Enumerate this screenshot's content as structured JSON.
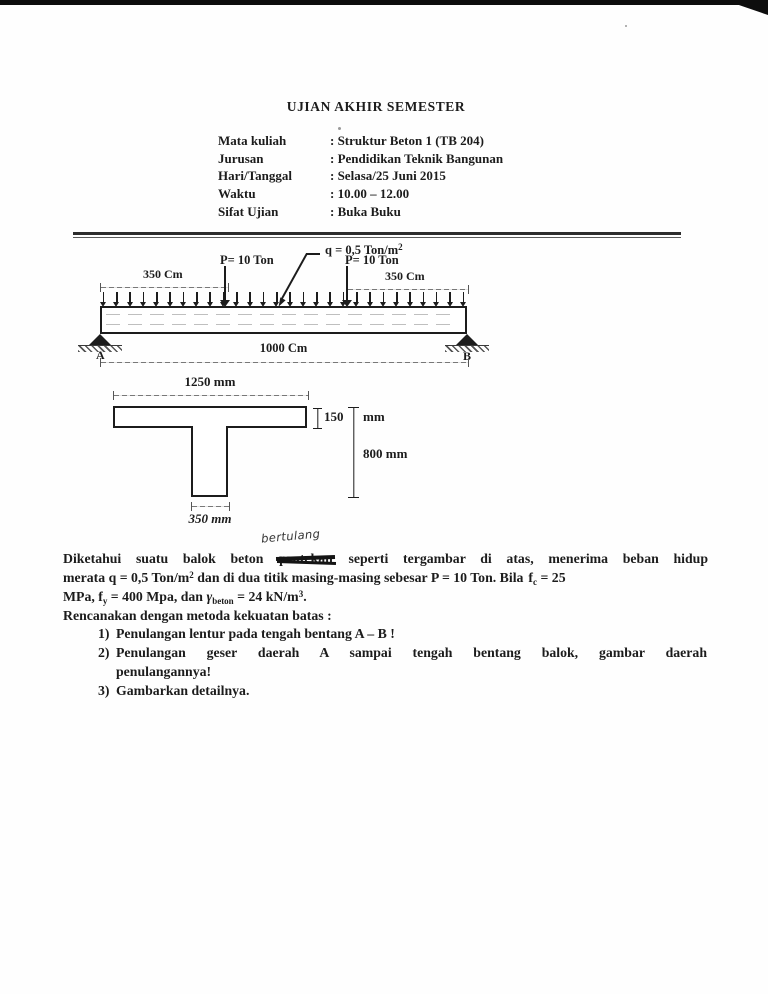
{
  "colors": {
    "ink": "#1c1c1c",
    "paper": "#fefefe",
    "dim_line": "#787878"
  },
  "header": {
    "title": "UJIAN AKHIR SEMESTER",
    "rows": [
      {
        "label": "Mata kuliah",
        "value": ": Struktur Beton 1 (TB 204)"
      },
      {
        "label": "Jurusan",
        "value": ": Pendidikan Teknik Bangunan"
      },
      {
        "label": "Hari/Tanggal",
        "value": ": Selasa/25 Juni 2015"
      },
      {
        "label": "Waktu",
        "value": ": 10.00 – 12.00"
      },
      {
        "label": "Sifat Ujian",
        "value": ": Buka Buku"
      }
    ]
  },
  "beam": {
    "q_label": "q = 0,5 Ton/m",
    "q_sup": "2",
    "p_left": "P= 10 Ton",
    "p_right": "P= 10 Ton",
    "span_left": "350 Cm",
    "span_right": "350 Cm",
    "span_total": "1000 Cm",
    "support_a": "A",
    "support_b": "B"
  },
  "section": {
    "top_width": "1250 mm",
    "flange_thickness": "150",
    "flange_unit": "mm",
    "total_depth": "800 mm",
    "web_width": "350 mm"
  },
  "problem": {
    "handwritten_note": "bertulang",
    "line1_pre": "Diketahui suatu balok beton ",
    "line1_struck": "pratekan",
    "line1_post": " seperti tergambar di atas, menerima beban hidup",
    "line2_a": "merata q = 0,5 Ton/m",
    "line2_sup": "2",
    "line2_b": " dan di dua titik masing-masing sebesar P = 10 Ton. Bila",
    "line2_f": "f",
    "line2_sub": "c",
    "line2_c": " = 25",
    "line3_a": "MPa, f",
    "line3_sub_y": "y",
    "line3_b": " = 400 Mpa, dan ",
    "line3_gamma": "γ",
    "line3_sub_beton": "beton",
    "line3_c": " = 24 kN/m",
    "line3_sup": "3",
    "line3_d": ".",
    "line4": "Rencanakan dengan metoda kekuatan batas :",
    "items": [
      {
        "num": "1)",
        "text": "Penulangan lentur pada tengah bentang A – B !"
      },
      {
        "num": "2)",
        "text": "Penulangan geser daerah A sampai tengah bentang balok, gambar daerah",
        "text2": "penulangannya!"
      },
      {
        "num": "3)",
        "text": "Gambarkan detailnya."
      }
    ]
  }
}
